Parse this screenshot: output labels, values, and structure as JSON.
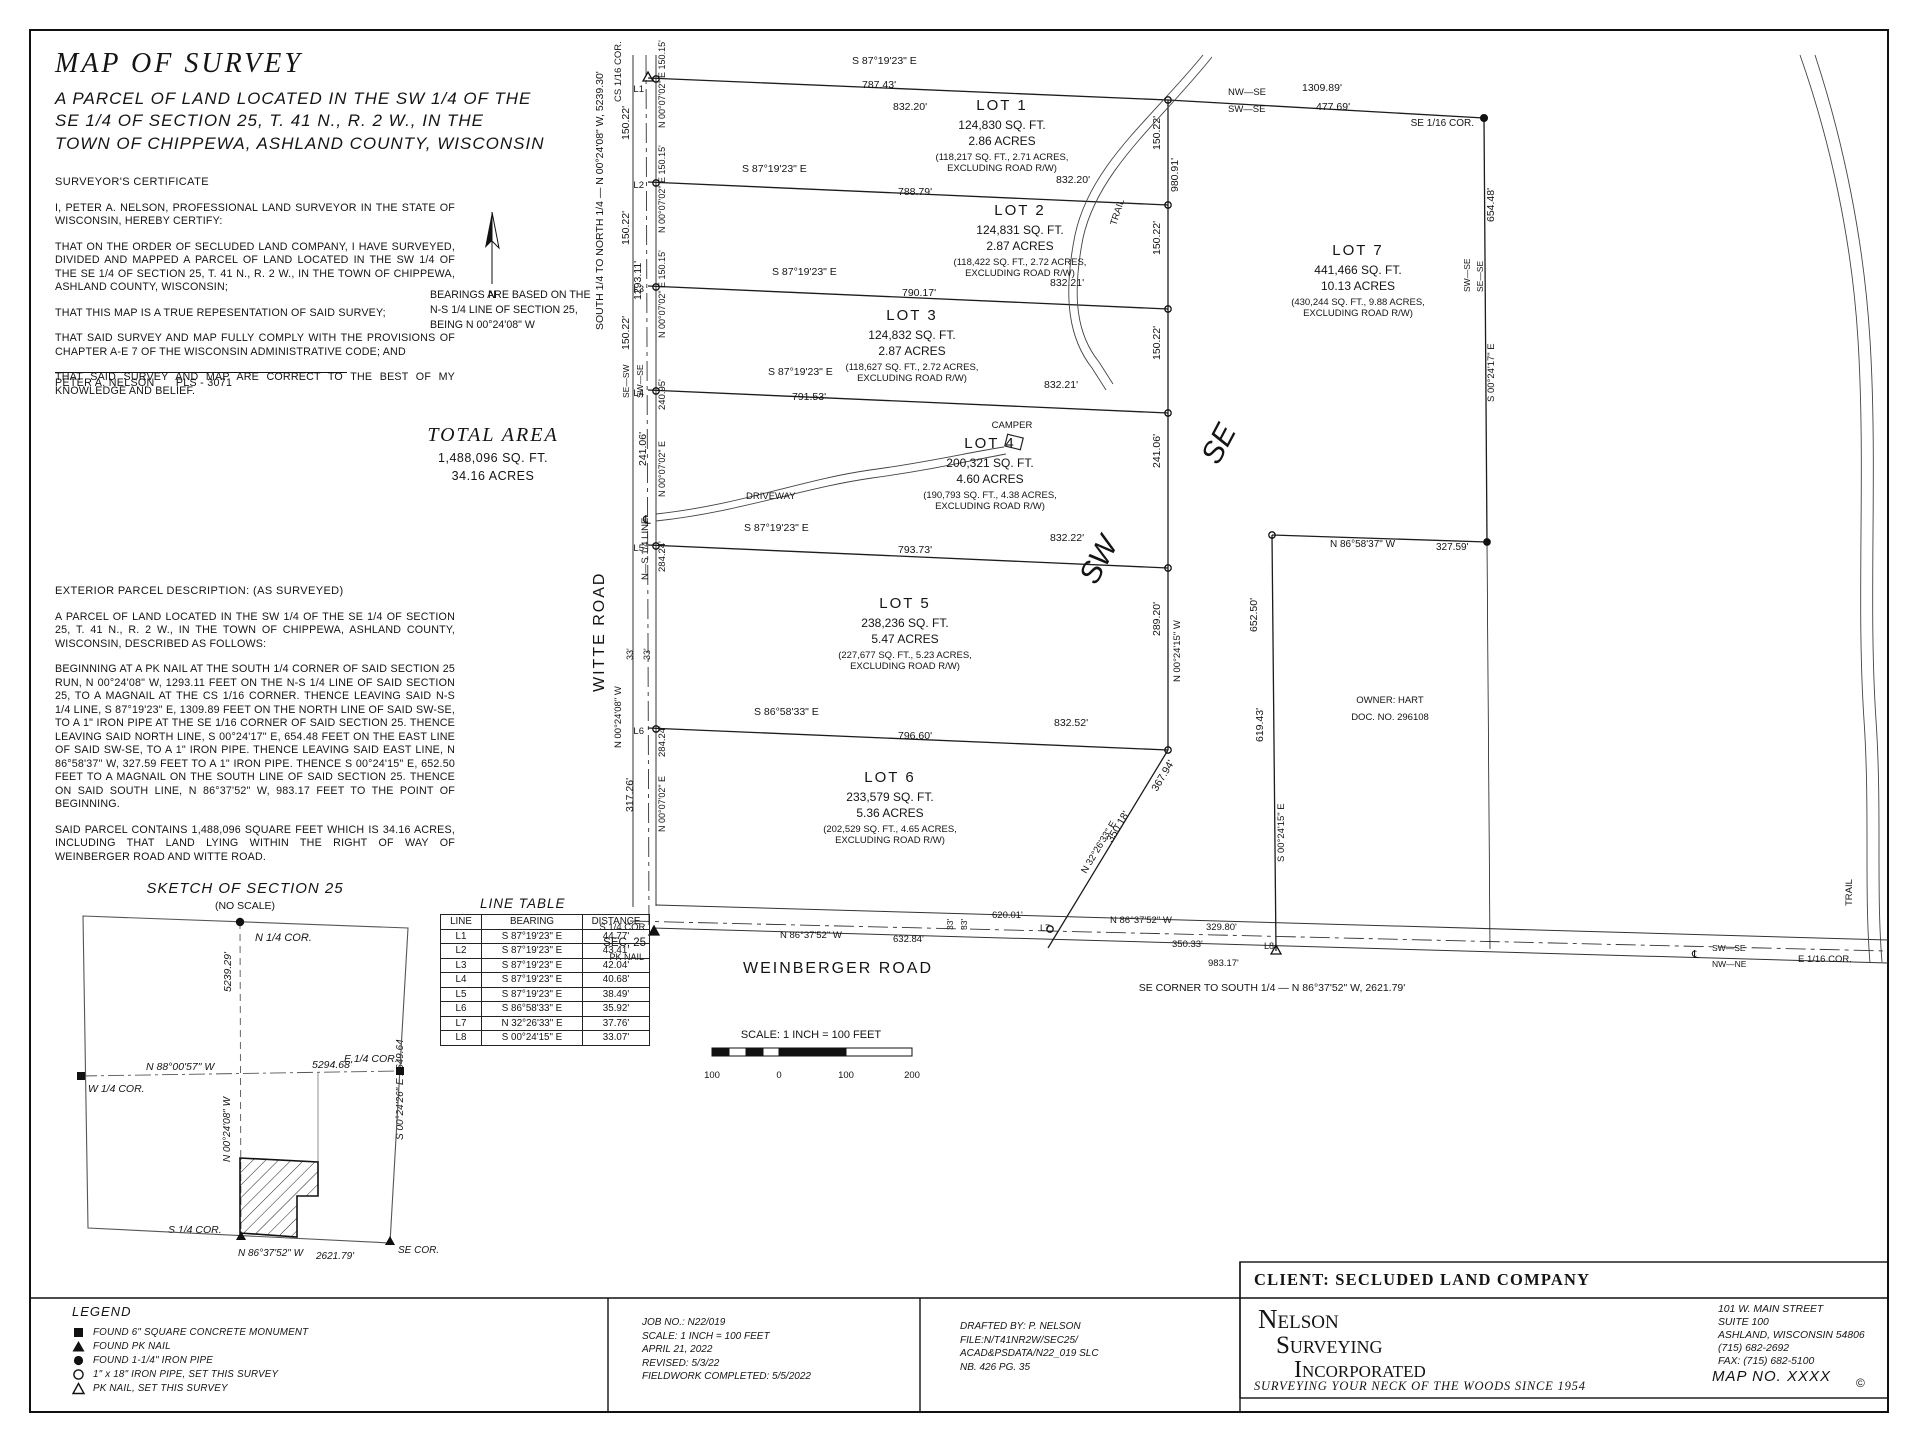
{
  "title_block": {
    "title": "MAP OF SURVEY",
    "subtitle": [
      "A PARCEL OF LAND LOCATED IN THE SW 1/4 OF THE",
      "SE 1/4 OF SECTION 25, T. 41 N., R. 2 W., IN THE",
      "TOWN OF CHIPPEWA, ASHLAND COUNTY, WISCONSIN"
    ]
  },
  "certificate": {
    "heading": "SURVEYOR'S CERTIFICATE",
    "paragraphs": [
      "I, PETER A. NELSON, PROFESSIONAL LAND SURVEYOR IN THE STATE OF WISCONSIN, HEREBY CERTIFY:",
      "THAT ON THE ORDER OF SECLUDED LAND COMPANY, I HAVE SURVEYED, DIVIDED AND MAPPED A PARCEL OF LAND LOCATED IN THE SW 1/4 OF THE SE 1/4 OF SECTION 25, T. 41 N., R. 2 W., IN THE TOWN OF CHIPPEWA, ASHLAND COUNTY, WISCONSIN;",
      "THAT THIS MAP IS A TRUE REPESENTATION OF SAID SURVEY;",
      "THAT SAID SURVEY AND MAP FULLY COMPLY WITH THE PROVISIONS OF CHAPTER A-E 7 OF THE WISCONSIN ADMINISTRATIVE CODE; AND",
      "THAT SAID SURVEY AND MAP ARE CORRECT TO THE BEST OF MY KNOWLEDGE AND BELIEF."
    ],
    "signature_name": "PETER A. NELSON",
    "signature_title": "PLS - 3071"
  },
  "bearings_note": {
    "lines": [
      "BEARINGS ARE BASED ON THE",
      "N-S 1/4 LINE OF SECTION 25,",
      "BEING N 00°24'08\" W"
    ]
  },
  "total_area": {
    "heading": "TOTAL AREA",
    "sqft": "1,488,096 SQ. FT.",
    "acres": "34.16 ACRES"
  },
  "description": {
    "heading": "EXTERIOR PARCEL DESCRIPTION: (AS SURVEYED)",
    "paragraphs": [
      "A PARCEL OF LAND LOCATED IN THE SW 1/4 OF THE SE 1/4 OF SECTION 25, T. 41 N., R. 2 W., IN THE TOWN OF CHIPPEWA, ASHLAND COUNTY, WISCONSIN, DESCRIBED AS FOLLOWS:",
      "BEGINNING AT A PK NAIL AT THE SOUTH 1/4 CORNER OF SAID SECTION 25 RUN, N 00°24'08\" W, 1293.11 FEET ON THE N-S 1/4 LINE OF SAID SECTION 25, TO A MAGNAIL AT THE CS 1/16 CORNER.  THENCE LEAVING SAID N-S 1/4 LINE, S 87°19'23\" E, 1309.89 FEET ON THE NORTH LINE OF SAID SW-SE, TO A 1\" IRON PIPE AT THE SE 1/16 CORNER OF SAID SECTION 25.  THENCE LEAVING SAID NORTH LINE, S 00°24'17\" E, 654.48 FEET ON THE EAST LINE OF SAID SW-SE, TO A 1\" IRON PIPE.  THENCE LEAVING SAID EAST LINE, N 86°58'37\" W, 327.59 FEET TO A 1\" IRON PIPE.  THENCE S 00°24'15\" E, 652.50 FEET TO A MAGNAIL ON THE SOUTH LINE OF SAID SECTION 25.  THENCE ON SAID SOUTH LINE, N 86°37'52\" W, 983.17 FEET TO THE POINT OF BEGINNING.",
      "SAID PARCEL CONTAINS 1,488,096 SQUARE FEET WHICH IS 34.16 ACRES, INCLUDING THAT LAND LYING WITHIN THE RIGHT OF WAY OF WEINBERGER ROAD AND WITTE ROAD."
    ]
  },
  "line_table": {
    "title": "LINE TABLE",
    "headers": [
      "LINE",
      "BEARING",
      "DISTANCE"
    ],
    "rows": [
      [
        "L1",
        "S 87°19'23\" E",
        "44.77'"
      ],
      [
        "L2",
        "S 87°19'23\" E",
        "43.41'"
      ],
      [
        "L3",
        "S 87°19'23\" E",
        "42.04'"
      ],
      [
        "L4",
        "S 87°19'23\" E",
        "40.68'"
      ],
      [
        "L5",
        "S 87°19'23\" E",
        "38.49'"
      ],
      [
        "L6",
        "S 86°58'33\" E",
        "35.92'"
      ],
      [
        "L7",
        "N 32°26'33\" E",
        "37.76'"
      ],
      [
        "L8",
        "S 00°24'15\" E",
        "33.07'"
      ]
    ]
  },
  "legend": {
    "title": "LEGEND",
    "items": [
      {
        "symbol": "filled-square",
        "label": "FOUND 6\" SQUARE CONCRETE MONUMENT"
      },
      {
        "symbol": "filled-triangle",
        "label": "FOUND PK NAIL"
      },
      {
        "symbol": "filled-circle",
        "label": "FOUND 1-1/4\" IRON PIPE"
      },
      {
        "symbol": "open-circle",
        "label": "1\" x 18\" IRON PIPE, SET THIS SURVEY"
      },
      {
        "symbol": "open-triangle",
        "label": "PK NAIL, SET THIS SURVEY"
      }
    ]
  },
  "job_block": {
    "lines": [
      "JOB NO.: N22/019",
      "SCALE: 1 INCH = 100 FEET",
      "APRIL 21, 2022",
      "REVISED: 5/3/22",
      "FIELDWORK COMPLETED: 5/5/2022"
    ]
  },
  "drafting_block": {
    "lines": [
      "DRAFTED BY: P. NELSON",
      "FILE:N/T41NR2W/SEC25/",
      "ACAD&PSDATA/N22_019 SLC",
      "NB. 426 PG. 35"
    ]
  },
  "client_block": {
    "client": "CLIENT:  SECLUDED LAND COMPANY",
    "firm_lines": [
      "Nelson",
      "Surveying",
      "Incorporated"
    ],
    "tagline": "SURVEYING YOUR NECK OF THE WOODS SINCE 1954",
    "address_lines": [
      "101 W. MAIN STREET",
      "SUITE 100",
      "ASHLAND, WISCONSIN  54806",
      "(715) 682-2692",
      "FAX: (715) 682-5100"
    ],
    "map_no": "MAP NO. XXXX",
    "copyright": "©"
  },
  "map": {
    "lots": [
      {
        "name": "LOT 1",
        "x": 1002,
        "y": 110,
        "sqft": "124,830 SQ. FT.",
        "acres": "2.86 ACRES",
        "excl1": "(118,217 SQ. FT., 2.71 ACRES,",
        "excl2": "EXCLUDING ROAD R/W)"
      },
      {
        "name": "LOT 2",
        "x": 1020,
        "y": 215,
        "sqft": "124,831 SQ. FT.",
        "acres": "2.87 ACRES",
        "excl1": "(118,422 SQ. FT., 2.72 ACRES,",
        "excl2": "EXCLUDING ROAD R/W)"
      },
      {
        "name": "LOT 3",
        "x": 912,
        "y": 320,
        "sqft": "124,832 SQ. FT.",
        "acres": "2.87 ACRES",
        "excl1": "(118,627 SQ. FT., 2.72 ACRES,",
        "excl2": "EXCLUDING ROAD R/W)"
      },
      {
        "name": "LOT 4",
        "x": 990,
        "y": 448,
        "sqft": "200,321 SQ. FT.",
        "acres": "4.60 ACRES",
        "excl1": "(190,793 SQ. FT., 4.38 ACRES,",
        "excl2": "EXCLUDING ROAD R/W)"
      },
      {
        "name": "LOT 5",
        "x": 905,
        "y": 608,
        "sqft": "238,236 SQ. FT.",
        "acres": "5.47 ACRES",
        "excl1": "(227,677 SQ. FT., 5.23 ACRES,",
        "excl2": "EXCLUDING ROAD R/W)"
      },
      {
        "name": "LOT 6",
        "x": 890,
        "y": 782,
        "sqft": "233,579 SQ. FT.",
        "acres": "5.36 ACRES",
        "excl1": "(202,529 SQ. FT., 4.65 ACRES,",
        "excl2": "EXCLUDING ROAD R/W)"
      },
      {
        "name": "LOT 7",
        "x": 1358,
        "y": 255,
        "sqft": "441,466 SQ. FT.",
        "acres": "10.13 ACRES",
        "excl1": "(430,244 SQ. FT., 9.88 ACRES,",
        "excl2": "EXCLUDING ROAD R/W)"
      }
    ],
    "labels": [
      {
        "t": "S 87°19'23\" E",
        "x": 852,
        "y": 64
      },
      {
        "t": "787.43'",
        "x": 862,
        "y": 88
      },
      {
        "t": "832.20'",
        "x": 893,
        "y": 110
      },
      {
        "t": "NW—SE",
        "x": 1228,
        "y": 95,
        "s": 9.5
      },
      {
        "t": "1309.89'",
        "x": 1302,
        "y": 91
      },
      {
        "t": "SW—SE",
        "x": 1228,
        "y": 112,
        "s": 9.5
      },
      {
        "t": "477.69'",
        "x": 1316,
        "y": 110
      },
      {
        "t": "SE 1/16 COR.",
        "x": 1474,
        "y": 126,
        "a": "end",
        "s": 10,
        "n": "corner-label"
      },
      {
        "t": "S 87°19'23\" E",
        "x": 742,
        "y": 172
      },
      {
        "t": "788.79'",
        "x": 898,
        "y": 195
      },
      {
        "t": "832.20'",
        "x": 1056,
        "y": 183
      },
      {
        "t": "S 87°19'23\" E",
        "x": 772,
        "y": 275
      },
      {
        "t": "790.17'",
        "x": 902,
        "y": 296
      },
      {
        "t": "832.21'",
        "x": 1050,
        "y": 286
      },
      {
        "t": "S 87°19'23\" E",
        "x": 768,
        "y": 375
      },
      {
        "t": "791.53'",
        "x": 792,
        "y": 400
      },
      {
        "t": "832.21'",
        "x": 1044,
        "y": 388
      },
      {
        "t": "S 87°19'23\" E",
        "x": 744,
        "y": 531
      },
      {
        "t": "793.73'",
        "x": 898,
        "y": 553
      },
      {
        "t": "832.22'",
        "x": 1050,
        "y": 541
      },
      {
        "t": "S 86°58'33\" E",
        "x": 754,
        "y": 715
      },
      {
        "t": "796.60'",
        "x": 898,
        "y": 739
      },
      {
        "t": "832.52'",
        "x": 1054,
        "y": 726
      },
      {
        "t": "L1",
        "x": 644,
        "y": 92,
        "a": "end",
        "s": 9.5
      },
      {
        "t": "L2",
        "x": 644,
        "y": 188,
        "a": "end",
        "s": 9.5
      },
      {
        "t": "L3",
        "x": 644,
        "y": 292,
        "a": "end",
        "s": 9.5
      },
      {
        "t": "L4",
        "x": 644,
        "y": 396,
        "a": "end",
        "s": 9.5
      },
      {
        "t": "L5",
        "x": 644,
        "y": 551,
        "a": "end",
        "s": 9.5
      },
      {
        "t": "L6",
        "x": 644,
        "y": 734,
        "a": "end",
        "s": 9.5
      },
      {
        "t": "CS 1/16 COR.",
        "x": 621,
        "y": 102,
        "r": -90,
        "s": 9.5,
        "n": "corner-label"
      },
      {
        "t": "150.22'",
        "x": 629,
        "y": 140,
        "r": -90
      },
      {
        "t": "150.22'",
        "x": 629,
        "y": 245,
        "r": -90
      },
      {
        "t": "150.22'",
        "x": 629,
        "y": 350,
        "r": -90
      },
      {
        "t": "N 00°07'02\" E 150.15'",
        "x": 665,
        "y": 128,
        "r": -90,
        "s": 9
      },
      {
        "t": "N 00°07'02\" E 150.15'",
        "x": 665,
        "y": 233,
        "r": -90,
        "s": 9
      },
      {
        "t": "N 00°07'02\" E 150.15'",
        "x": 665,
        "y": 338,
        "r": -90,
        "s": 9
      },
      {
        "t": "1293.11'",
        "x": 641,
        "y": 300,
        "r": -90
      },
      {
        "t": "SE—SW",
        "x": 629,
        "y": 398,
        "r": -90,
        "s": 8.5
      },
      {
        "t": "SW—SE",
        "x": 643,
        "y": 398,
        "r": -90,
        "s": 8.5
      },
      {
        "t": "240.95'",
        "x": 665,
        "y": 410,
        "r": -90,
        "s": 9.5
      },
      {
        "t": "241.06'",
        "x": 646,
        "y": 466,
        "r": -90
      },
      {
        "t": "N 00°07'02\" E",
        "x": 665,
        "y": 497,
        "r": -90,
        "s": 9
      },
      {
        "t": "℄",
        "x": 643,
        "y": 524,
        "s": 12
      },
      {
        "t": "SOUTH 1/4 TO NORTH 1/4 — N 00°24'08\" W, 5239.30'",
        "x": 603,
        "y": 330,
        "r": -90,
        "s": 10.5
      },
      {
        "t": "N—S 1/4 LINE",
        "x": 648,
        "y": 580,
        "r": -90,
        "s": 9.5
      },
      {
        "t": "284.24'",
        "x": 665,
        "y": 572,
        "r": -90,
        "s": 9.5
      },
      {
        "t": "33'",
        "x": 633,
        "y": 660,
        "r": -90,
        "s": 9
      },
      {
        "t": "33'",
        "x": 650,
        "y": 660,
        "r": -90,
        "s": 9
      },
      {
        "t": "WITTE ROAD",
        "x": 604,
        "y": 692,
        "r": -90,
        "s": 16,
        "n": "road-label",
        "ls": 2
      },
      {
        "t": "N 00°24'08\" W",
        "x": 621,
        "y": 748,
        "r": -90,
        "s": 9.5
      },
      {
        "t": "284.24'",
        "x": 665,
        "y": 757,
        "r": -90,
        "s": 9.5
      },
      {
        "t": "317.26'",
        "x": 633,
        "y": 812,
        "r": -90
      },
      {
        "t": "N 00°07'02\" E",
        "x": 665,
        "y": 832,
        "r": -90,
        "s": 9
      },
      {
        "t": "150.22'",
        "x": 1160,
        "y": 150,
        "r": -90
      },
      {
        "t": "980.91'",
        "x": 1178,
        "y": 192,
        "r": -90
      },
      {
        "t": "150.22'",
        "x": 1160,
        "y": 255,
        "r": -90
      },
      {
        "t": "150.22'",
        "x": 1160,
        "y": 360,
        "r": -90
      },
      {
        "t": "241.06'",
        "x": 1160,
        "y": 468,
        "r": -90
      },
      {
        "t": "289.20'",
        "x": 1160,
        "y": 636,
        "r": -90
      },
      {
        "t": "N 00°24'15\" W",
        "x": 1180,
        "y": 682,
        "r": -90,
        "s": 9.5
      },
      {
        "t": "367.94'",
        "x": 1157,
        "y": 792,
        "r": -59
      },
      {
        "t": "350.18'",
        "x": 1112,
        "y": 843,
        "r": -59
      },
      {
        "t": "N 32°26'33\" E",
        "x": 1086,
        "y": 874,
        "r": -59,
        "s": 9.5
      },
      {
        "t": "SE",
        "x": 1218,
        "y": 466,
        "r": -62,
        "s": 30,
        "i": 1,
        "n": "quarter-label"
      },
      {
        "t": "SW",
        "x": 1096,
        "y": 586,
        "r": -62,
        "s": 30,
        "i": 1,
        "n": "quarter-label"
      },
      {
        "t": "TRAIL",
        "x": 1116,
        "y": 226,
        "r": -72,
        "s": 9.5,
        "n": "poi-label"
      },
      {
        "t": "CAMPER",
        "x": 1012,
        "y": 428,
        "s": 9.5,
        "a": "middle",
        "n": "poi-label"
      },
      {
        "t": "DRIVEWAY",
        "x": 746,
        "y": 499,
        "s": 9.5,
        "n": "poi-label"
      },
      {
        "t": "TRAIL",
        "x": 1852,
        "y": 906,
        "r": -90,
        "s": 9.5,
        "n": "poi-label"
      },
      {
        "t": "654.48'",
        "x": 1494,
        "y": 222,
        "r": -90
      },
      {
        "t": "SW—SE",
        "x": 1470,
        "y": 292,
        "r": -90,
        "s": 8.5
      },
      {
        "t": "SE—SE",
        "x": 1483,
        "y": 292,
        "r": -90,
        "s": 8.5
      },
      {
        "t": "S 00°24'17\" E",
        "x": 1494,
        "y": 402,
        "r": -90,
        "s": 9.5
      },
      {
        "t": "N 86°58'37\" W",
        "x": 1330,
        "y": 547,
        "s": 10
      },
      {
        "t": "327.59'",
        "x": 1436,
        "y": 550,
        "s": 10
      },
      {
        "t": "652.50'",
        "x": 1257,
        "y": 632,
        "r": -90
      },
      {
        "t": "619.43'",
        "x": 1263,
        "y": 742,
        "r": -90
      },
      {
        "t": "S 00°24'15\" E",
        "x": 1284,
        "y": 862,
        "r": -90,
        "s": 9.5
      },
      {
        "t": "OWNER: HART",
        "x": 1390,
        "y": 703,
        "s": 9.5,
        "a": "middle",
        "n": "owner-label"
      },
      {
        "t": "DOC. NO. 296108",
        "x": 1390,
        "y": 720,
        "s": 9.5,
        "a": "middle",
        "n": "owner-label"
      },
      {
        "t": "S 1/4 COR.",
        "x": 648,
        "y": 930,
        "a": "end",
        "s": 9.5,
        "n": "corner-label"
      },
      {
        "t": "SEC. 25",
        "x": 646,
        "y": 946,
        "a": "end",
        "s": 11.5
      },
      {
        "t": "PK NAIL",
        "x": 644,
        "y": 960,
        "a": "end",
        "s": 9
      },
      {
        "t": "N 86°37'52\" W",
        "x": 780,
        "y": 938,
        "s": 9.5
      },
      {
        "t": "632.84'",
        "x": 893,
        "y": 942,
        "s": 9.5
      },
      {
        "t": "33'",
        "x": 953,
        "y": 930,
        "r": -90,
        "s": 8.5
      },
      {
        "t": "33'",
        "x": 967,
        "y": 930,
        "r": -90,
        "s": 8.5
      },
      {
        "t": "620.01'",
        "x": 992,
        "y": 918,
        "s": 9.5
      },
      {
        "t": "L7",
        "x": 1040,
        "y": 931,
        "s": 9
      },
      {
        "t": "N 86°37'52\" W",
        "x": 1110,
        "y": 923,
        "s": 9.5
      },
      {
        "t": "329.80'",
        "x": 1206,
        "y": 930,
        "s": 9.5
      },
      {
        "t": "350.33'",
        "x": 1172,
        "y": 947,
        "s": 9.5
      },
      {
        "t": "L8",
        "x": 1264,
        "y": 949,
        "s": 9
      },
      {
        "t": "983.17'",
        "x": 1208,
        "y": 966,
        "s": 9.5
      },
      {
        "t": "℄",
        "x": 1692,
        "y": 958,
        "s": 11
      },
      {
        "t": "SW—SE",
        "x": 1712,
        "y": 951,
        "s": 8.5
      },
      {
        "t": "NW—NE",
        "x": 1712,
        "y": 967,
        "s": 8.5
      },
      {
        "t": "E 1/16 COR.",
        "x": 1798,
        "y": 962,
        "s": 9.5,
        "n": "corner-label"
      },
      {
        "t": "WEINB",
        "x": -100,
        "y": -100,
        "s": 1
      },
      {
        "t": "WEINBERGER ROAD",
        "x": 838,
        "y": 973,
        "s": 16,
        "a": "middle",
        "n": "road-label",
        "ls": 2
      },
      {
        "t": "SE CORNER TO SOUTH 1/4 — N 86°37'52\" W, 2621.79'",
        "x": 1272,
        "y": 991,
        "s": 10.5,
        "a": "middle"
      },
      {
        "t": "SCALE: 1 INCH = 100 FEET",
        "x": 811,
        "y": 1038,
        "a": "middle",
        "s": 11,
        "n": "scale-label"
      },
      {
        "t": "100",
        "x": 712,
        "y": 1078,
        "a": "middle",
        "s": 9.5,
        "n": "scale-tick"
      },
      {
        "t": "0",
        "x": 779,
        "y": 1078,
        "a": "middle",
        "s": 9.5,
        "n": "scale-tick"
      },
      {
        "t": "100",
        "x": 846,
        "y": 1078,
        "a": "middle",
        "s": 9.5,
        "n": "scale-tick"
      },
      {
        "t": "200",
        "x": 912,
        "y": 1078,
        "a": "middle",
        "s": 9.5,
        "n": "scale-tick"
      },
      {
        "t": "N",
        "x": 492,
        "y": 298,
        "a": "middle",
        "s": 11,
        "n": "north-arrow-label"
      },
      {
        "t": "SKETCH OF SECTION 25",
        "x": 245,
        "y": 893,
        "a": "middle",
        "s": 15,
        "i": 1,
        "n": "sketch-title",
        "ls": 1
      },
      {
        "t": "(NO SCALE)",
        "x": 245,
        "y": 909,
        "a": "middle",
        "s": 10.5,
        "n": "sketch-subtitle"
      },
      {
        "t": "N 1/4 COR.",
        "x": 255,
        "y": 941,
        "s": 11,
        "i": 1,
        "n": "corner-label"
      },
      {
        "t": "5239.29'",
        "x": 231,
        "y": 992,
        "r": -90,
        "s": 10.5,
        "i": 1
      },
      {
        "t": "N 88°00'57\" W",
        "x": 146,
        "y": 1070,
        "s": 10.5,
        "i": 1
      },
      {
        "t": "5294.68'",
        "x": 312,
        "y": 1068,
        "s": 10.5,
        "i": 1
      },
      {
        "t": "W 1/4 COR.",
        "x": 88,
        "y": 1092,
        "s": 10.5,
        "i": 1,
        "n": "corner-label"
      },
      {
        "t": "E 1/4 COR.",
        "x": 344,
        "y": 1062,
        "s": 10.5,
        "i": 1,
        "n": "corner-label"
      },
      {
        "t": "N 00°24'08\" W",
        "x": 230,
        "y": 1162,
        "r": -90,
        "s": 10,
        "i": 1
      },
      {
        "t": "S 00°24'26\" E  2649.64",
        "x": 403,
        "y": 1140,
        "r": -90,
        "s": 10,
        "i": 1
      },
      {
        "t": "S 1/4 COR.",
        "x": 168,
        "y": 1233,
        "s": 10.5,
        "i": 1,
        "n": "corner-label"
      },
      {
        "t": "N 86°37'52\" W",
        "x": 238,
        "y": 1256,
        "s": 10,
        "i": 1
      },
      {
        "t": "2621.79'",
        "x": 316,
        "y": 1259,
        "s": 10,
        "i": 1
      },
      {
        "t": "SE COR.",
        "x": 398,
        "y": 1253,
        "s": 10,
        "i": 1,
        "n": "corner-label"
      }
    ]
  }
}
